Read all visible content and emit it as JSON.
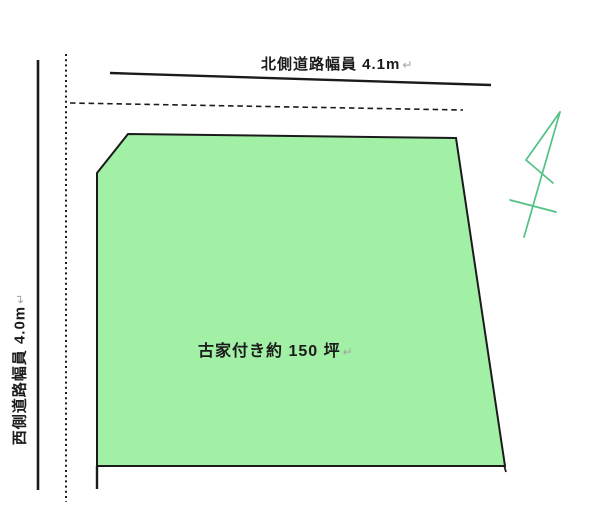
{
  "labels": {
    "north_road": {
      "text": "北側道路幅員 4.1m",
      "return_mark": "↵"
    },
    "west_road": {
      "text": "西側道路幅員 4.0m",
      "return_mark": "↵"
    },
    "parcel": {
      "text": "古家付き約 150 坪",
      "return_mark": "↵"
    }
  },
  "colors": {
    "parcel_fill": "#a2f0a6",
    "line": "#1b1b1b",
    "north_arrow": "#52c183",
    "return_mark": "#a3a3a3"
  },
  "icons": {
    "north_arrow": "hand-drawn north arrow sketch"
  }
}
